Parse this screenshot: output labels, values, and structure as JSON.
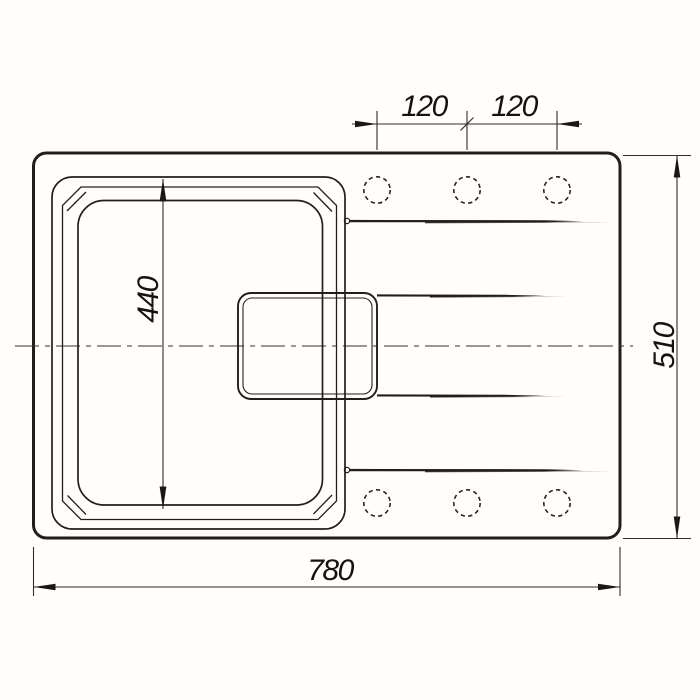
{
  "diagram": {
    "type": "technical-drawing",
    "subject": "sink-top-view",
    "dimensions": {
      "hole_spacing_left": "120",
      "hole_spacing_right": "120",
      "overall_length": "780",
      "overall_width": "510",
      "bowl_length": "440"
    }
  },
  "colors": {
    "line": "#241e1a",
    "background": "#ffffff"
  }
}
